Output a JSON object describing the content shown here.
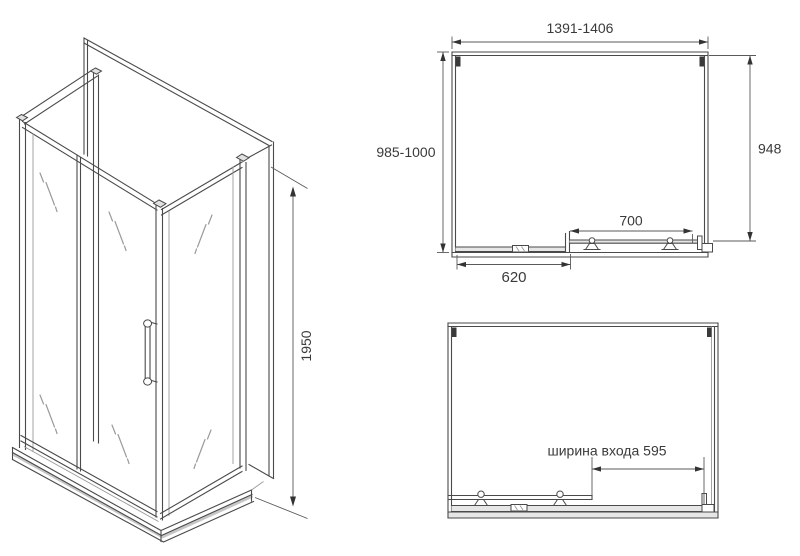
{
  "colors": {
    "background": "#ffffff",
    "line": "#4a4a4a",
    "light_line": "#999999",
    "dimension_line": "#5a5a5a",
    "text": "#3a3a3a",
    "shade": "#c6c6c6"
  },
  "iso_view": {
    "height_label": "1950"
  },
  "top_view": {
    "width_range_label": "1391-1406",
    "depth_range_label": "985-1000",
    "right_depth_label": "948",
    "door_width_label": "700",
    "fixed_panel_width_label": "620"
  },
  "front_view": {
    "entrance_width_label": "ширина входа 595"
  }
}
